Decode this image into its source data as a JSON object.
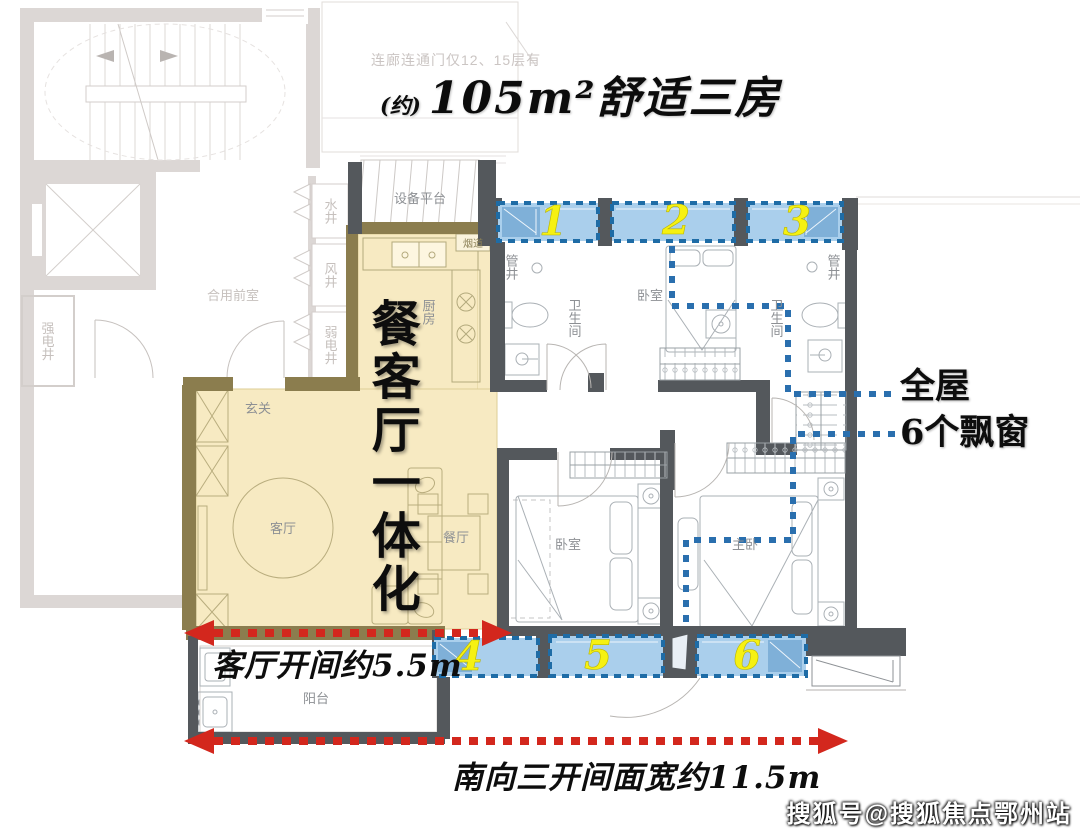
{
  "title": {
    "approx": "(约)",
    "main": "105m²舒适三房"
  },
  "top_note": "连廊连通门仅12、15层有",
  "common_area": {
    "shared_lobby": "合用前室",
    "strong_elec_shaft": "强电井",
    "water_shaft": "水井",
    "air_shaft": "风井",
    "weak_elec_shaft": "弱电井"
  },
  "unit_rooms": {
    "equipment_platform": "设备平台",
    "flue": "烟道",
    "kitchen": "厨房",
    "entry": "玄关",
    "living_room": "客厅",
    "dining_room": "餐厅",
    "balcony": "阳台",
    "bedroom": "卧室",
    "master_bedroom": "主卧",
    "bathroom": "卫生间",
    "pipe_shaft": "管井"
  },
  "annotations": {
    "slogan_vertical": "餐客厅一体化",
    "bay_callout_line1": "全屋",
    "bay_callout_line2": "6个飘窗",
    "dim_living": "客厅开间约5.5m",
    "dim_south": "南向三开间面宽约11.5m",
    "bay_numbers": [
      "1",
      "2",
      "3",
      "4",
      "5",
      "6"
    ]
  },
  "watermark": "搜狐号@搜狐焦点鄂州站",
  "colors": {
    "highlight_fill": "#f7eac2",
    "highlight_wall": "#8b7d4e",
    "wall_dark": "#54585c",
    "bay_fill": "#aacfec",
    "bay_border": "#1e6ca6",
    "bay_number": "#f6f112",
    "dim_red": "#d3271d",
    "callout_blue": "#2a6fae",
    "faded_gray": "#dcd7d5"
  }
}
